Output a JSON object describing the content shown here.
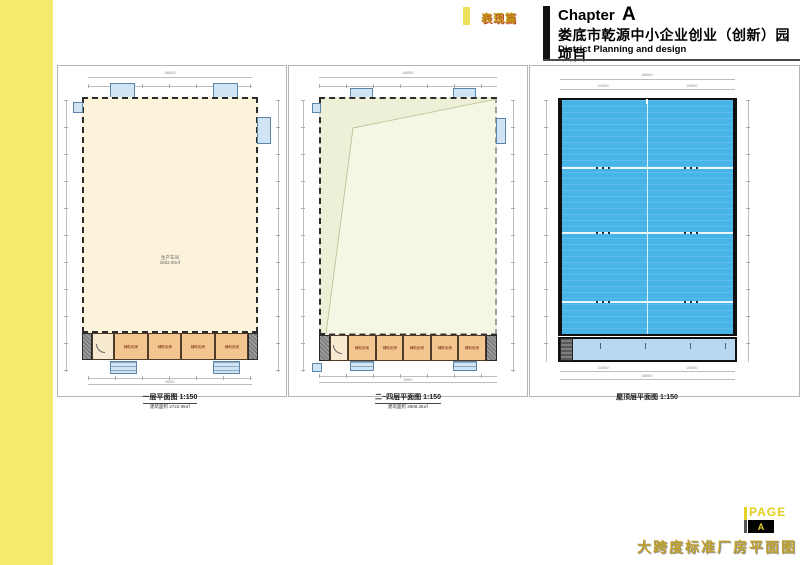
{
  "header": {
    "tab_label": "表现篇",
    "chapter_word": "Chapter",
    "chapter_letter": "A",
    "title_cn": "娄底市乾源中小企业创业（创新）园项目",
    "subtitle_en": "District Planning and design"
  },
  "plans": [
    {
      "caption": "一层平面图 1:150",
      "caption_sub": "建筑面积 2722.95㎡",
      "center_label": "生产车间",
      "center_sub": "2592.00㎡",
      "room_label": "辅助用房",
      "dim_overall": "48000",
      "dim_bay": "8000"
    },
    {
      "caption": "二~四层平面图 1:150",
      "caption_sub": "建筑面积 2608.35㎡",
      "room_label": "辅助用房",
      "dim_overall": "48000",
      "dim_bay": "8000"
    },
    {
      "caption": "屋顶层平面图 1:150",
      "dim_overall": "48000",
      "dim_half": "24000"
    }
  ],
  "footer": {
    "page_word": "PAGE",
    "page_letter": "A",
    "doc_title": "大跨度标准厂房平面图"
  },
  "colors": {
    "sidebar_yellow": "#f5e96e",
    "roof_blue": "#47b4e8",
    "lower_roof_blue": "#b9d8f0",
    "hall_cream": "#fbf3da",
    "hall_green": "#edf0d6",
    "room_orange": "#f3c690",
    "canopy_blue": "#cfe4f4",
    "accent_gold": "#bfa02a"
  }
}
